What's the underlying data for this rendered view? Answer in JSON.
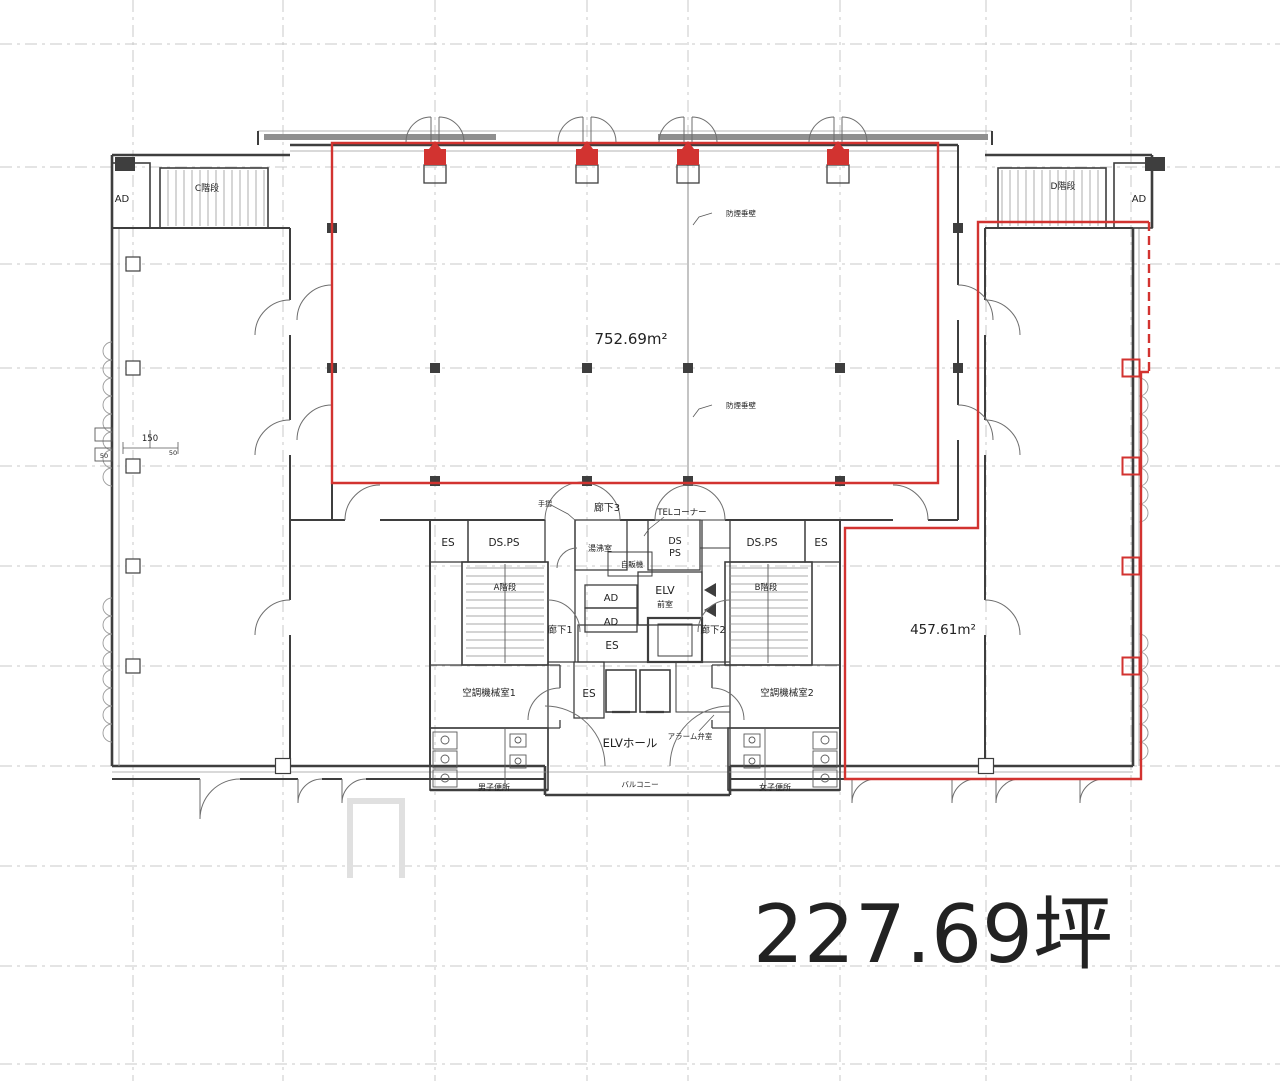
{
  "summary": {
    "total_area_tsubo": "227.69坪",
    "zone_area_upper": "752.69m²",
    "zone_area_right": "457.61m²"
  },
  "colors": {
    "outline_red": "#d23330",
    "area_green": "#84ca84",
    "wall_dark": "#3e3e3e",
    "grid_gray": "#c9c9c9",
    "text_black": "#222222",
    "total_text": "#161616"
  },
  "labels": [
    {
      "name": "label-ad-topleft",
      "text": "AD",
      "x": 122,
      "y": 202,
      "size": 10
    },
    {
      "name": "label-c-stair",
      "text": "C階段",
      "x": 207,
      "y": 191,
      "size": 9
    },
    {
      "name": "label-d-stair",
      "text": "D階段",
      "x": 1063,
      "y": 189,
      "size": 9
    },
    {
      "name": "label-ad-topright",
      "text": "AD",
      "x": 1139,
      "y": 202,
      "size": 10
    },
    {
      "name": "label-area-upper",
      "text": "752.69m²",
      "x": 631,
      "y": 344,
      "size": 15,
      "color": "#84ca84"
    },
    {
      "name": "label-area-right",
      "text": "457.61m²",
      "x": 943,
      "y": 634,
      "size": 13.5,
      "color": "#84ca84"
    },
    {
      "name": "label-smoke-wall-1",
      "text": "防煙垂壁",
      "x": 741,
      "y": 216,
      "size": 7.5
    },
    {
      "name": "label-smoke-wall-2",
      "text": "防煙垂壁",
      "x": 741,
      "y": 408,
      "size": 7.5
    },
    {
      "name": "label-corridor-3",
      "text": "廊下3",
      "x": 607,
      "y": 511,
      "size": 10
    },
    {
      "name": "label-tesuri",
      "text": "手摺",
      "x": 545,
      "y": 506,
      "size": 7
    },
    {
      "name": "label-tel-corner",
      "text": "TELコーナー",
      "x": 682,
      "y": 515,
      "size": 8.5
    },
    {
      "name": "label-es-topleft",
      "text": "ES",
      "x": 448,
      "y": 546,
      "size": 10.5
    },
    {
      "name": "label-dsps-left",
      "text": "DS.PS",
      "x": 504,
      "y": 546,
      "size": 10.5
    },
    {
      "name": "label-yuwakashi",
      "text": "湯沸室",
      "x": 600,
      "y": 551,
      "size": 8
    },
    {
      "name": "label-jihanki",
      "text": "自販機",
      "x": 632,
      "y": 567,
      "size": 7.5
    },
    {
      "name": "label-ds-mid",
      "text": "DS",
      "x": 675,
      "y": 544,
      "size": 9.5
    },
    {
      "name": "label-ps-mid",
      "text": "PS",
      "x": 675,
      "y": 556,
      "size": 9.5
    },
    {
      "name": "label-dsps-right",
      "text": "DS.PS",
      "x": 762,
      "y": 546,
      "size": 10.5
    },
    {
      "name": "label-es-topright",
      "text": "ES",
      "x": 821,
      "y": 546,
      "size": 10.5
    },
    {
      "name": "label-a-stair",
      "text": "A階段",
      "x": 505,
      "y": 590,
      "size": 8.5
    },
    {
      "name": "label-b-stair",
      "text": "B階段",
      "x": 766,
      "y": 590,
      "size": 8.5
    },
    {
      "name": "label-ad-core-1",
      "text": "AD",
      "x": 611,
      "y": 601,
      "size": 10
    },
    {
      "name": "label-ad-core-2",
      "text": "AD",
      "x": 611,
      "y": 625,
      "size": 10
    },
    {
      "name": "label-elv",
      "text": "ELV",
      "x": 665,
      "y": 594,
      "size": 11
    },
    {
      "name": "label-elv-sub",
      "text": "前室",
      "x": 665,
      "y": 607,
      "size": 8
    },
    {
      "name": "label-corridor-1",
      "text": "廊下1",
      "x": 560,
      "y": 633,
      "size": 9.5
    },
    {
      "name": "label-corridor-2",
      "text": "廊下2",
      "x": 713,
      "y": 633,
      "size": 9.5
    },
    {
      "name": "label-es-center",
      "text": "ES",
      "x": 612,
      "y": 649,
      "size": 10.5
    },
    {
      "name": "label-es-lower",
      "text": "ES",
      "x": 589,
      "y": 697,
      "size": 10.5
    },
    {
      "name": "label-ac-room-1",
      "text": "空調機械室1",
      "x": 489,
      "y": 696,
      "size": 9.5
    },
    {
      "name": "label-ac-room-2",
      "text": "空調機械室2",
      "x": 787,
      "y": 696,
      "size": 9.5
    },
    {
      "name": "label-elv-hall",
      "text": "ELVホール",
      "x": 630,
      "y": 747,
      "size": 11.5
    },
    {
      "name": "label-alarm-valve",
      "text": "アラーム弁室",
      "x": 690,
      "y": 739,
      "size": 7.5
    },
    {
      "name": "label-mens-wc",
      "text": "男子便所",
      "x": 494,
      "y": 790,
      "size": 8
    },
    {
      "name": "label-womens-wc",
      "text": "女子便所",
      "x": 775,
      "y": 790,
      "size": 8
    },
    {
      "name": "label-balcony",
      "text": "バルコニー",
      "x": 640,
      "y": 787,
      "size": 7.5
    },
    {
      "name": "label-dim-150",
      "text": "150",
      "x": 150,
      "y": 441,
      "size": 8.5,
      "color": "#444444"
    },
    {
      "name": "label-dim-50a",
      "text": "50",
      "x": 104,
      "y": 458,
      "size": 6.5,
      "color": "#555555"
    },
    {
      "name": "label-dim-50b",
      "text": "50",
      "x": 173,
      "y": 455,
      "size": 6.5,
      "color": "#555555"
    },
    {
      "name": "label-total-area",
      "text": "227.69坪",
      "x": 933,
      "y": 962,
      "size": 80,
      "color": "#161616"
    }
  ]
}
